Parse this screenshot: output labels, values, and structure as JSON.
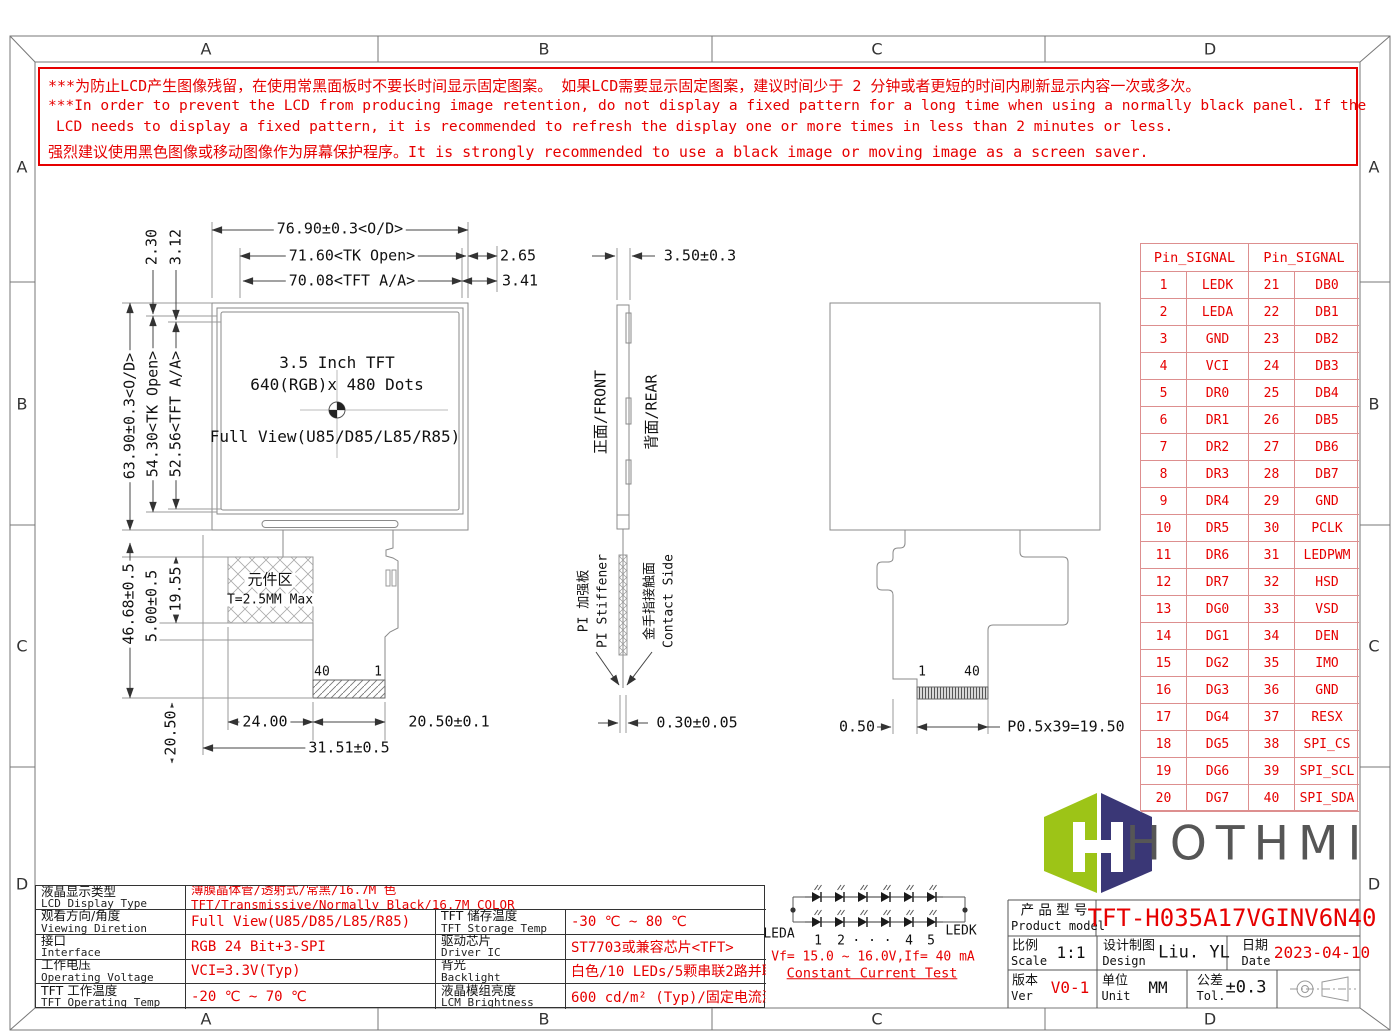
{
  "warning": {
    "line1": "***为防止LCD产生图像残留，在使用常黑面板时不要长时间显示固定图案。 如果LCD需要显示固定图案，建议时间少于 2 分钟或者更短的时间内刷新显示内容一次或多次。",
    "line2": "***In order to prevent the LCD from producing image retention, do not display a fixed pattern for a long time when using a normally black panel. If the",
    "line3": "LCD needs to display a fixed pattern, it is recommended to refresh the display one or more times in less than 2 minutes or less.",
    "line4": "强烈建议使用黑色图像或移动图像作为屏幕保护程序。It is strongly recommended to use a black image or moving image as a screen saver."
  },
  "zones": {
    "letters": [
      "A",
      "B",
      "C",
      "D"
    ]
  },
  "front_view": {
    "screen_line1": "3.5 Inch TFT",
    "screen_line2": "640(RGB)x 480 Dots",
    "screen_line3": "Full View(U85/D85/L85/R85)",
    "component_area_line1": "元件区",
    "component_area_line2": "T=2.5MM Max",
    "pin_left": "40",
    "pin_right": "1",
    "dims": {
      "outline_width": "76.90±0.3<O/D>",
      "tk_open_width": "71.60<TK Open>",
      "tk_open_offset": "2.65",
      "active_width": "70.08<TFT A/A>",
      "active_offset": "3.41",
      "top_offset1": "2.30",
      "top_offset2": "3.12",
      "outline_height": "63.90±0.3<O/D>",
      "tk_open_height": "54.30<TK Open>",
      "active_height": "52.56<TFT A/A>",
      "lower_height": "46.68±0.5",
      "gap_height": "5.00±0.5",
      "component_height": "19.55",
      "tail_height": "20.50",
      "component_width": "24.00",
      "connector_width": "20.50±0.1",
      "tail_width": "31.51±0.5"
    }
  },
  "side_view": {
    "thickness": "3.50±0.3",
    "front_label": "正面/FRONT",
    "rear_label": "背面/REAR",
    "stiffener_cn": "PI 加强板",
    "stiffener_en": "PI Stiffener",
    "contact_cn": "金手指接触面",
    "contact_en": "Contact Side",
    "fpc_thickness": "0.30±0.05"
  },
  "rear_view": {
    "pin_left": "1",
    "pin_right": "40",
    "edge_margin": "0.50",
    "pitch": "P0.5x39=19.50"
  },
  "pin_table": {
    "header_left": "Pin_SIGNAL",
    "header_right": "Pin_SIGNAL",
    "rows": [
      [
        "1",
        "LEDK",
        "21",
        "DB0"
      ],
      [
        "2",
        "LEDA",
        "22",
        "DB1"
      ],
      [
        "3",
        "GND",
        "23",
        "DB2"
      ],
      [
        "4",
        "VCI",
        "24",
        "DB3"
      ],
      [
        "5",
        "DR0",
        "25",
        "DB4"
      ],
      [
        "6",
        "DR1",
        "26",
        "DB5"
      ],
      [
        "7",
        "DR2",
        "27",
        "DB6"
      ],
      [
        "8",
        "DR3",
        "28",
        "DB7"
      ],
      [
        "9",
        "DR4",
        "29",
        "GND"
      ],
      [
        "10",
        "DR5",
        "30",
        "PCLK"
      ],
      [
        "11",
        "DR6",
        "31",
        "LEDPWM"
      ],
      [
        "12",
        "DR7",
        "32",
        "HSD"
      ],
      [
        "13",
        "DG0",
        "33",
        "VSD"
      ],
      [
        "14",
        "DG1",
        "34",
        "DEN"
      ],
      [
        "15",
        "DG2",
        "35",
        "IMO"
      ],
      [
        "16",
        "DG3",
        "36",
        "GND"
      ],
      [
        "17",
        "DG4",
        "37",
        "RESX"
      ],
      [
        "18",
        "DG5",
        "38",
        "SPI_CS"
      ],
      [
        "19",
        "DG6",
        "39",
        "SPI_SCL"
      ],
      [
        "20",
        "DG7",
        "40",
        "SPI_SDA"
      ]
    ]
  },
  "spec_table": {
    "display_type_label_cn": "液晶显示类型",
    "display_type_label_en": "LCD Display Type",
    "display_type_value_cn": "薄膜晶体管/透射式/常黑/16.7M 色",
    "display_type_value_en": "TFT/Transmissive/Normally Black/16.7M COLOR",
    "left_rows": [
      {
        "label_cn": "观看方向/角度",
        "label_en": "Viewing Diretion",
        "value": "Full View(U85/D85/L85/R85)"
      },
      {
        "label_cn": "接口",
        "label_en": "Interface",
        "value": "RGB 24 Bit+3-SPI"
      },
      {
        "label_cn": "工作电压",
        "label_en": "Operating Voltage",
        "value": "VCI=3.3V(Typ)"
      },
      {
        "label_cn": "TFT 工作温度",
        "label_en": "TFT Operating Temp",
        "value": "-20 ℃ ~ 70 ℃"
      }
    ],
    "right_rows": [
      {
        "label_cn": "TFT 储存温度",
        "label_en": "TFT Storage Temp",
        "value": "-30 ℃ ~ 80 ℃"
      },
      {
        "label_cn": "驱动芯片",
        "label_en": "Driver IC",
        "value": "ST7703或兼容芯片<TFT>"
      },
      {
        "label_cn": "背光",
        "label_en": "Backlight",
        "value": "白色/10 LEDs/5颗串联2路并联"
      },
      {
        "label_cn": "液晶模组亮度",
        "label_en": "LCM Brightness",
        "value": "600 cd/m² (Typ)/固定电流测试"
      }
    ]
  },
  "led_circuit": {
    "anode_label": "LEDA",
    "cathode_label": "LEDK",
    "index_labels": [
      "1",
      "2",
      "· · ·",
      "4",
      "5"
    ],
    "spec_line": "Vf= 15.0 ~ 16.0V,If= 40 mA",
    "test_line": "Constant Current Test"
  },
  "logo": {
    "text": "HOTHMI",
    "green": "#9dc417",
    "navy": "#3a3776"
  },
  "title_block": {
    "product_label_cn": "产 品 型 号",
    "product_label_en": "Product model",
    "product_model": "TFT-H035A17VGINV6N40",
    "scale_label_cn": "比例",
    "scale_label_en": "Scale",
    "scale_value": "1:1",
    "design_label_cn": "设计制图",
    "design_label_en": "Design",
    "design_value": "Liu. YL",
    "date_label_cn": "日期",
    "date_label_en": "Date",
    "date_value": "2023-04-10",
    "version_label_cn": "版本",
    "version_label_en": "Ver",
    "version_value": "V0-1",
    "unit_label_cn": "单位",
    "unit_label_en": "Unit",
    "unit_value": "MM",
    "tolerance_label_cn": "公差",
    "tolerance_label_en": "Tol.",
    "tolerance_value": "±0.3"
  }
}
